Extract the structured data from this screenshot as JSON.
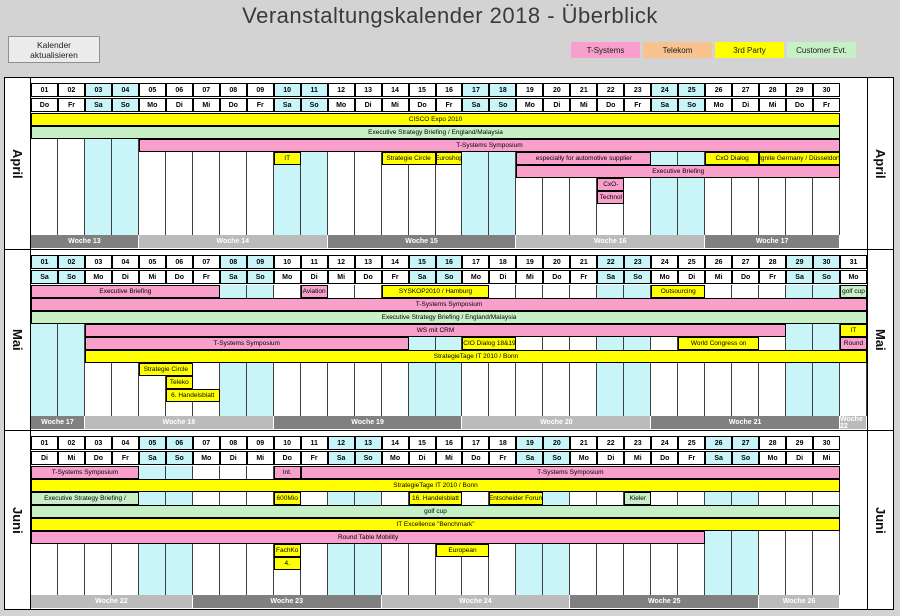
{
  "title": "Veranstaltungskalender 2018 - Überblick",
  "toolbar": {
    "refresh_button": "Kalender aktualisieren"
  },
  "colors": {
    "t_systems": "#F89FCB",
    "telekom": "#F9C291",
    "third_party": "#FFFF00",
    "customer_evt": "#C7F0C7",
    "weekend": "#C9F4F8",
    "week_dark": "#808080",
    "week_light": "#BBBBBB"
  },
  "legend": [
    {
      "label": "T-Systems",
      "color_key": "t_systems"
    },
    {
      "label": "Telekom",
      "color_key": "telekom"
    },
    {
      "label": "3rd Party",
      "color_key": "third_party"
    },
    {
      "label": "Customer Evt.",
      "color_key": "customer_evt"
    }
  ],
  "months": [
    {
      "name": "April",
      "days": [
        {
          "n": "01",
          "d": "Do"
        },
        {
          "n": "02",
          "d": "Fr"
        },
        {
          "n": "03",
          "d": "Sa"
        },
        {
          "n": "04",
          "d": "So"
        },
        {
          "n": "05",
          "d": "Mo"
        },
        {
          "n": "06",
          "d": "Di"
        },
        {
          "n": "07",
          "d": "Mi"
        },
        {
          "n": "08",
          "d": "Do"
        },
        {
          "n": "09",
          "d": "Fr"
        },
        {
          "n": "10",
          "d": "Sa"
        },
        {
          "n": "11",
          "d": "So"
        },
        {
          "n": "12",
          "d": "Mo"
        },
        {
          "n": "13",
          "d": "Di"
        },
        {
          "n": "14",
          "d": "Mi"
        },
        {
          "n": "15",
          "d": "Do"
        },
        {
          "n": "16",
          "d": "Fr"
        },
        {
          "n": "17",
          "d": "Sa"
        },
        {
          "n": "18",
          "d": "So"
        },
        {
          "n": "19",
          "d": "Mo"
        },
        {
          "n": "20",
          "d": "Di"
        },
        {
          "n": "21",
          "d": "Mi"
        },
        {
          "n": "22",
          "d": "Do"
        },
        {
          "n": "23",
          "d": "Fr"
        },
        {
          "n": "24",
          "d": "Sa"
        },
        {
          "n": "25",
          "d": "So"
        },
        {
          "n": "26",
          "d": "Mo"
        },
        {
          "n": "27",
          "d": "Di"
        },
        {
          "n": "28",
          "d": "Mi"
        },
        {
          "n": "29",
          "d": "Do"
        },
        {
          "n": "30",
          "d": "Fr"
        }
      ],
      "rows": [
        [
          {
            "t": "CISCO Expo 2010",
            "s": 1,
            "e": 30,
            "c": "third_party"
          }
        ],
        [
          {
            "t": "Executive Strategy Briefing / England/Malaysia",
            "s": 1,
            "e": 30,
            "c": "customer_evt"
          }
        ],
        [
          {
            "t": "T-Systems Symposium",
            "s": 5,
            "e": 30,
            "c": "t_systems"
          }
        ],
        [
          {
            "t": "IT",
            "s": 10,
            "e": 10,
            "c": "third_party"
          },
          {
            "t": "Strategie Circle",
            "s": 14,
            "e": 15,
            "c": "third_party"
          },
          {
            "t": "Euroshop",
            "s": 16,
            "e": 16,
            "c": "third_party"
          },
          {
            "t": "especially for automotive supplier",
            "s": 19,
            "e": 23,
            "c": "t_systems"
          },
          {
            "t": "CxO Dialog",
            "s": 26,
            "e": 27,
            "c": "third_party"
          },
          {
            "t": "Ignite Germany / Düsseldorf",
            "s": 28,
            "e": 30,
            "c": "third_party"
          }
        ],
        [
          {
            "t": "Executive Briefing",
            "s": 19,
            "e": 30,
            "c": "t_systems"
          }
        ],
        [
          {
            "t": "CxO-",
            "s": 22,
            "e": 22,
            "c": "t_systems"
          }
        ],
        [
          {
            "t": "Technol",
            "s": 22,
            "e": 22,
            "c": "t_systems"
          }
        ]
      ],
      "weeks": [
        {
          "t": "Woche 13",
          "s": 1,
          "e": 4,
          "shade": "dark"
        },
        {
          "t": "Woche 14",
          "s": 5,
          "e": 11,
          "shade": "light"
        },
        {
          "t": "Woche 15",
          "s": 12,
          "e": 18,
          "shade": "dark"
        },
        {
          "t": "Woche 16",
          "s": 19,
          "e": 25,
          "shade": "light"
        },
        {
          "t": "Woche 17",
          "s": 26,
          "e": 30,
          "shade": "dark"
        }
      ]
    },
    {
      "name": "Mai",
      "days": [
        {
          "n": "01",
          "d": "Sa"
        },
        {
          "n": "02",
          "d": "So"
        },
        {
          "n": "03",
          "d": "Mo"
        },
        {
          "n": "04",
          "d": "Di"
        },
        {
          "n": "05",
          "d": "Mi"
        },
        {
          "n": "06",
          "d": "Do"
        },
        {
          "n": "07",
          "d": "Fr"
        },
        {
          "n": "08",
          "d": "Sa"
        },
        {
          "n": "09",
          "d": "So"
        },
        {
          "n": "10",
          "d": "Mo"
        },
        {
          "n": "11",
          "d": "Di"
        },
        {
          "n": "12",
          "d": "Mi"
        },
        {
          "n": "13",
          "d": "Do"
        },
        {
          "n": "14",
          "d": "Fr"
        },
        {
          "n": "15",
          "d": "Sa"
        },
        {
          "n": "16",
          "d": "So"
        },
        {
          "n": "17",
          "d": "Mo"
        },
        {
          "n": "18",
          "d": "Di"
        },
        {
          "n": "19",
          "d": "Mi"
        },
        {
          "n": "20",
          "d": "Do"
        },
        {
          "n": "21",
          "d": "Fr"
        },
        {
          "n": "22",
          "d": "Sa"
        },
        {
          "n": "23",
          "d": "So"
        },
        {
          "n": "24",
          "d": "Mo"
        },
        {
          "n": "25",
          "d": "Di"
        },
        {
          "n": "26",
          "d": "Mi"
        },
        {
          "n": "27",
          "d": "Do"
        },
        {
          "n": "28",
          "d": "Fr"
        },
        {
          "n": "29",
          "d": "Sa"
        },
        {
          "n": "30",
          "d": "So"
        },
        {
          "n": "31",
          "d": "Mo"
        }
      ],
      "rows": [
        [
          {
            "t": "Executive Briefing",
            "s": 1,
            "e": 7,
            "c": "t_systems"
          },
          {
            "t": "Aviation",
            "s": 11,
            "e": 11,
            "c": "t_systems"
          },
          {
            "t": "SYSKOP2010 / Hamburg",
            "s": 14,
            "e": 17,
            "c": "third_party"
          },
          {
            "t": "Outsourcing",
            "s": 24,
            "e": 25,
            "c": "third_party"
          },
          {
            "t": "golf cup",
            "s": 31,
            "e": 31,
            "c": "customer_evt"
          }
        ],
        [
          {
            "t": "T-Systems Symposium",
            "s": 1,
            "e": 31,
            "c": "t_systems"
          }
        ],
        [
          {
            "t": "Executive Strategy Briefing / England/Malaysia",
            "s": 1,
            "e": 31,
            "c": "customer_evt"
          }
        ],
        [
          {
            "t": "WS mit CRM",
            "s": 3,
            "e": 28,
            "c": "t_systems"
          },
          {
            "t": "IT",
            "s": 31,
            "e": 31,
            "c": "third_party"
          }
        ],
        [
          {
            "t": "T-Systems Symposium",
            "s": 3,
            "e": 14,
            "c": "t_systems"
          },
          {
            "t": "CIO Dialog 18&19",
            "s": 17,
            "e": 18,
            "c": "third_party"
          },
          {
            "t": "World Congress on",
            "s": 25,
            "e": 27,
            "c": "third_party"
          },
          {
            "t": "Round",
            "s": 31,
            "e": 31,
            "c": "t_systems"
          }
        ],
        [
          {
            "t": "StrategieTage IT 2010 / Bonn",
            "s": 3,
            "e": 31,
            "c": "third_party"
          }
        ],
        [
          {
            "t": "Strategie Circle",
            "s": 5,
            "e": 6,
            "c": "third_party"
          }
        ],
        [
          {
            "t": "Teleko",
            "s": 6,
            "e": 6,
            "c": "third_party"
          }
        ],
        [
          {
            "t": "6. Handelsblatt",
            "s": 6,
            "e": 7,
            "c": "third_party"
          }
        ]
      ],
      "weeks": [
        {
          "t": "Woche 17",
          "s": 1,
          "e": 2,
          "shade": "dark"
        },
        {
          "t": "Woche 18",
          "s": 3,
          "e": 9,
          "shade": "light"
        },
        {
          "t": "Woche 19",
          "s": 10,
          "e": 16,
          "shade": "dark"
        },
        {
          "t": "Woche 20",
          "s": 17,
          "e": 23,
          "shade": "light"
        },
        {
          "t": "Woche 21",
          "s": 24,
          "e": 30,
          "shade": "dark"
        },
        {
          "t": "Woche 22",
          "s": 31,
          "e": 31,
          "shade": "light"
        }
      ]
    },
    {
      "name": "Juni",
      "days": [
        {
          "n": "01",
          "d": "Di"
        },
        {
          "n": "02",
          "d": "Mi"
        },
        {
          "n": "03",
          "d": "Do"
        },
        {
          "n": "04",
          "d": "Fr"
        },
        {
          "n": "05",
          "d": "Sa"
        },
        {
          "n": "06",
          "d": "So"
        },
        {
          "n": "07",
          "d": "Mo"
        },
        {
          "n": "08",
          "d": "Di"
        },
        {
          "n": "09",
          "d": "Mi"
        },
        {
          "n": "10",
          "d": "Do"
        },
        {
          "n": "11",
          "d": "Fr"
        },
        {
          "n": "12",
          "d": "Sa"
        },
        {
          "n": "13",
          "d": "So"
        },
        {
          "n": "14",
          "d": "Mo"
        },
        {
          "n": "15",
          "d": "Di"
        },
        {
          "n": "16",
          "d": "Mi"
        },
        {
          "n": "17",
          "d": "Do"
        },
        {
          "n": "18",
          "d": "Fr"
        },
        {
          "n": "19",
          "d": "Sa"
        },
        {
          "n": "20",
          "d": "So"
        },
        {
          "n": "21",
          "d": "Mo"
        },
        {
          "n": "22",
          "d": "Di"
        },
        {
          "n": "23",
          "d": "Mi"
        },
        {
          "n": "24",
          "d": "Do"
        },
        {
          "n": "25",
          "d": "Fr"
        },
        {
          "n": "26",
          "d": "Sa"
        },
        {
          "n": "27",
          "d": "So"
        },
        {
          "n": "28",
          "d": "Mo"
        },
        {
          "n": "29",
          "d": "Di"
        },
        {
          "n": "30",
          "d": "Mi"
        }
      ],
      "rows": [
        [
          {
            "t": "T-Systems Symposium",
            "s": 1,
            "e": 4,
            "c": "t_systems"
          },
          {
            "t": "Int.",
            "s": 10,
            "e": 10,
            "c": "t_systems"
          },
          {
            "t": "T-Systems Symposium",
            "s": 11,
            "e": 30,
            "c": "t_systems"
          }
        ],
        [
          {
            "t": "StrategieTage IT 2010 / Bonn",
            "s": 1,
            "e": 30,
            "c": "third_party"
          }
        ],
        [
          {
            "t": "Executive Strategy Briefing /",
            "s": 1,
            "e": 4,
            "c": "customer_evt"
          },
          {
            "t": "600Mio",
            "s": 10,
            "e": 10,
            "c": "third_party"
          },
          {
            "t": "16. Handelsblatt",
            "s": 15,
            "e": 16,
            "c": "third_party"
          },
          {
            "t": "Entscheider Forum",
            "s": 18,
            "e": 19,
            "c": "third_party"
          },
          {
            "t": "Kieler",
            "s": 23,
            "e": 23,
            "c": "customer_evt"
          }
        ],
        [
          {
            "t": "golf cup",
            "s": 1,
            "e": 30,
            "c": "customer_evt"
          }
        ],
        [
          {
            "t": "IT Excellence \"Benchmark\"",
            "s": 1,
            "e": 30,
            "c": "third_party"
          }
        ],
        [
          {
            "t": "Round Table Mobility",
            "s": 1,
            "e": 25,
            "c": "t_systems"
          }
        ],
        [
          {
            "t": "FachKo",
            "s": 10,
            "e": 10,
            "c": "third_party"
          },
          {
            "t": "European",
            "s": 16,
            "e": 17,
            "c": "third_party"
          }
        ],
        [
          {
            "t": "4.",
            "s": 10,
            "e": 10,
            "c": "third_party"
          }
        ]
      ],
      "weeks": [
        {
          "t": "Woche 22",
          "s": 1,
          "e": 6,
          "shade": "light"
        },
        {
          "t": "Woche 23",
          "s": 7,
          "e": 13,
          "shade": "dark"
        },
        {
          "t": "Woche 24",
          "s": 14,
          "e": 20,
          "shade": "light"
        },
        {
          "t": "Woche 25",
          "s": 21,
          "e": 27,
          "shade": "dark"
        },
        {
          "t": "Woche 26",
          "s": 28,
          "e": 30,
          "shade": "light"
        }
      ]
    }
  ]
}
